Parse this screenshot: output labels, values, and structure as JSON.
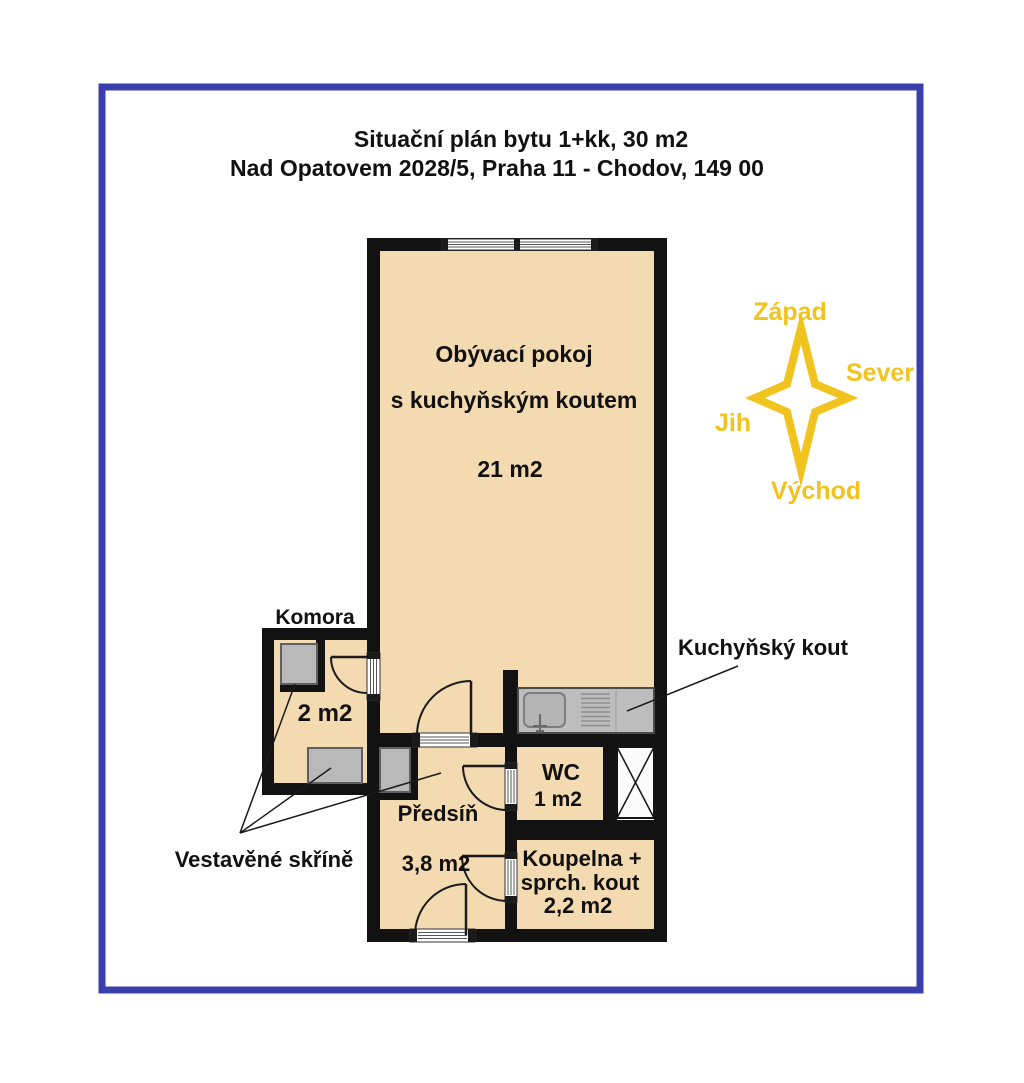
{
  "title": {
    "line1": "Situační plán bytu 1+kk, 30 m2",
    "line2": "Nad Opatovem 2028/5, Praha 11 - Chodov, 149 00"
  },
  "rooms": {
    "living": {
      "name": "Obývací pokoj",
      "subname": "s kuchyňským koutem",
      "area": "21 m2"
    },
    "komora": {
      "name": "Komora",
      "area": "2 m2"
    },
    "predsin": {
      "name": "Předsíň",
      "area": "3,8 m2"
    },
    "wc": {
      "name": "WC",
      "area": "1 m2"
    },
    "koupelna": {
      "name": "Koupelna +",
      "subname": "sprch. kout",
      "area": "2,2 m2"
    }
  },
  "callouts": {
    "kitchen": "Kuchyňský kout",
    "wardrobes": "Vestavěné skříně"
  },
  "compass": {
    "top": "Západ",
    "right": "Sever",
    "left": "Jih",
    "bottom": "Východ"
  },
  "colors": {
    "frame": "#3b3fad",
    "wall": "#121212",
    "room_fill": "#f4dab1",
    "furniture": "#b9b9b9",
    "counter": "#bdbdbd",
    "compass_accent": "#f0c31e"
  }
}
